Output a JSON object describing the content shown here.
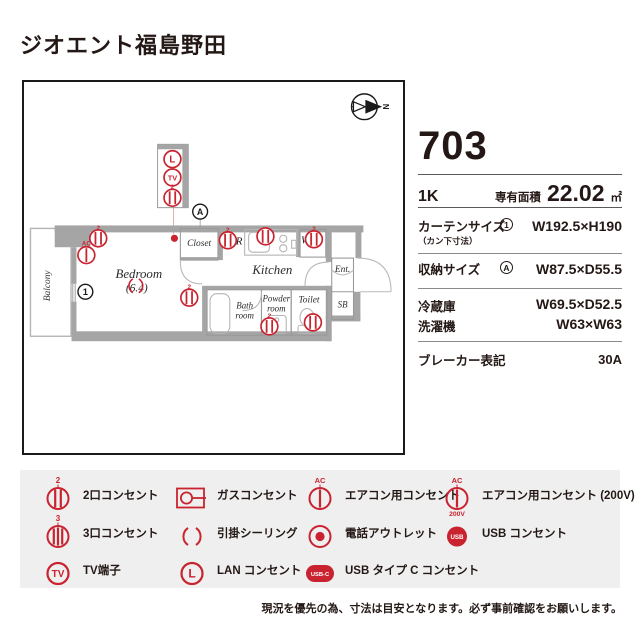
{
  "title": "ジオエント福島野田",
  "unit": {
    "number": "703",
    "layout": "1K",
    "area_label": "専有面積",
    "area_value": "22.02",
    "area_unit": "㎡"
  },
  "specs": {
    "curtain": {
      "label": "カーテンサイズ",
      "sublabel": "（カン下寸法）",
      "ref": "1",
      "value": "W192.5×H190"
    },
    "storage": {
      "label": "収納サイズ",
      "ref": "A",
      "value": "W87.5×D55.5"
    },
    "fridge": {
      "label": "冷蔵庫",
      "value": "W69.5×D52.5"
    },
    "washer": {
      "label": "洗濯機",
      "value": "W63×W63"
    },
    "breaker": {
      "label": "ブレーカー表記",
      "value": "30A"
    }
  },
  "plan": {
    "compass_n": "N",
    "rooms": {
      "balcony": "Balcony",
      "bedroom": "Bedroom",
      "bedroom_size": "(6.4)",
      "closet": "Closet",
      "kitchen": "Kitchen",
      "bath_line1": "Bath",
      "bath_line2": "room",
      "powder_line1": "Powder",
      "powder_line2": "room",
      "toilet": "Toilet",
      "entrance": "Ent.",
      "shoebox": "SB"
    },
    "labels": {
      "lan": "L",
      "tv": "TV",
      "two": "2",
      "ac": "AC",
      "fridge": "R",
      "washer": "W",
      "ref_one": "1",
      "ref_a": "A"
    }
  },
  "legend": {
    "badges": {
      "two": "2",
      "three": "3",
      "ac": "AC",
      "v200": "200V",
      "tv": "TV",
      "lan": "L",
      "usb": "USB",
      "usbc": "USB-C"
    },
    "items": [
      {
        "label": "2口コンセント"
      },
      {
        "label": "ガスコンセント"
      },
      {
        "label": "エアコン用コンセント"
      },
      {
        "label": "エアコン用コンセント (200V)"
      },
      {
        "label": "3口コンセント"
      },
      {
        "label": "引掛シーリング"
      },
      {
        "label": "電話アウトレット"
      },
      {
        "label": "USB コンセント"
      },
      {
        "label": "TV端子"
      },
      {
        "label": "LAN コンセント"
      },
      {
        "label": "USB タイプ C コンセント"
      }
    ]
  },
  "disclaimer": "現況を優先の為、寸法は目安となります。必ず事前確認をお願いします。",
  "colors": {
    "accent_red": "#c8232f",
    "text_dark": "#231815",
    "wall_gray": "#a5a5a5",
    "legend_bg": "#efefef"
  }
}
